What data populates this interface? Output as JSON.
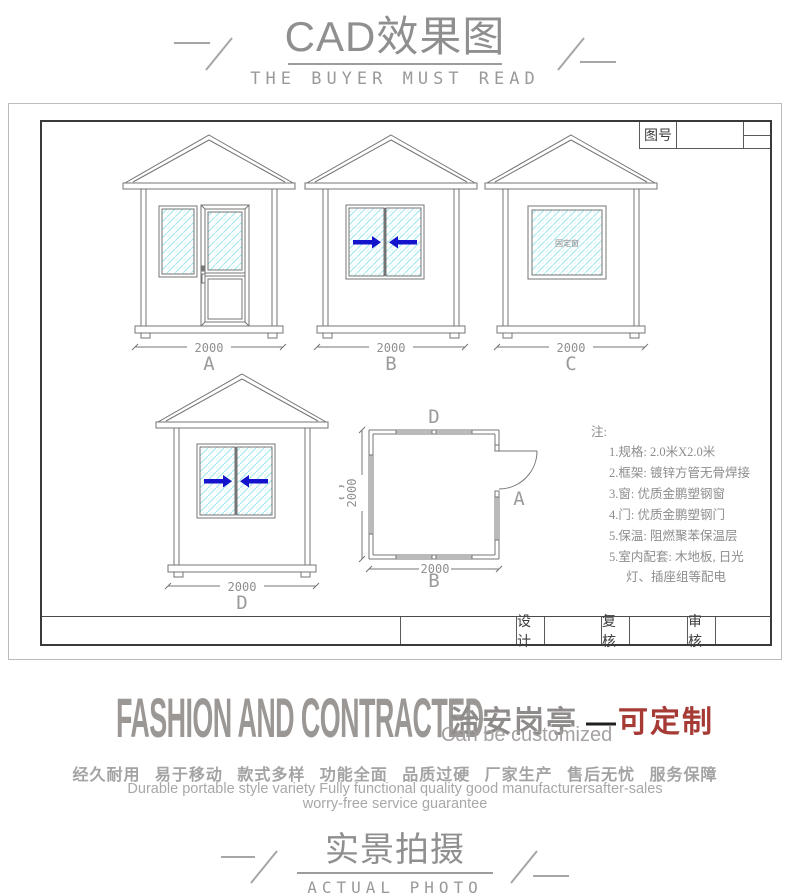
{
  "header": {
    "title": "CAD效果图",
    "subtitle": "THE BUYER MUST READ"
  },
  "sheet": {
    "drawing_no_label": "图号",
    "title_block": {
      "design_label": "设计",
      "review_label": "复核",
      "audit_label": "审核"
    },
    "fixed_window_label": "固定窗",
    "elevations": [
      {
        "label": "A",
        "dim": "2000"
      },
      {
        "label": "B",
        "dim": "2000"
      },
      {
        "label": "C",
        "dim": "2000"
      },
      {
        "label": "D",
        "dim": "2000"
      }
    ],
    "plan": {
      "top_label": "D",
      "left_label": "C",
      "bottom_label": "B",
      "right_label": "A",
      "width_dim": "2000",
      "height_dim": "2000"
    },
    "notes": {
      "heading": "注:",
      "items": [
        "1.规格: 2.0米X2.0米",
        "2.框架: 镀锌方管无骨焊接",
        "3.窗: 优质金鹏塑钢窗",
        "4.门: 优质金鹏塑钢门",
        "5.保温: 阻燃聚苯保温层",
        "5.室内配套: 木地板, 日光",
        "灯、插座组等配电"
      ]
    }
  },
  "promo": {
    "headline_en": "FASHION AND CONTRACTED",
    "product_name": "治安岗亭",
    "dash": "—",
    "customizable": "可定制",
    "customizable_en": "Can be customized",
    "features_cn": "经久耐用 易于移动 款式多样 功能全面 品质过硬 厂家生产 售后无忧 服务保障",
    "features_en_line1": "Durable portable style variety Fully functional quality good manufacturersafter-sales",
    "features_en_line2": "worry-free service guarantee"
  },
  "footer": {
    "title": "实景拍摄",
    "subtitle": "ACTUAL PHOTO"
  },
  "colors": {
    "accent_red": "#a63a35",
    "arrow_blue": "#1414cc",
    "hatch_cyan": "#a9e9ee",
    "text_gray": "#8f8f8f",
    "line_gray": "#747474"
  }
}
